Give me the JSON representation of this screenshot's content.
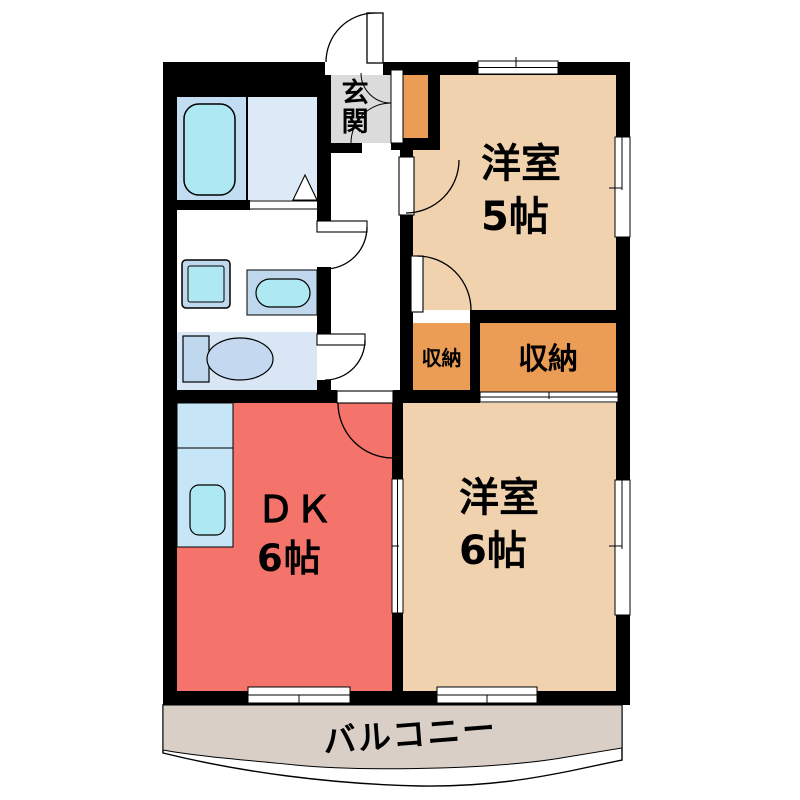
{
  "floorplan": {
    "type": "apartment-floor-plan",
    "entrance": {
      "label": "玄関"
    },
    "rooms": {
      "western5": {
        "name": "洋室",
        "size": "5帖"
      },
      "western6": {
        "name": "洋室",
        "size": "6帖"
      },
      "dk": {
        "name": "ＤＫ",
        "size": "6帖"
      },
      "closet_small": {
        "label": "収納"
      },
      "closet_large": {
        "label": "収納"
      },
      "balcony": {
        "label": "バルコニー"
      }
    },
    "fixtures": [
      "bathtub",
      "bath-door-triangle",
      "washing-machine",
      "wash-basin",
      "toilet",
      "kitchen-counter",
      "kitchen-sink",
      "shoe-cabinet"
    ],
    "colors": {
      "wall": "#000000",
      "room_peach": "#F1D2AF",
      "closet_orange": "#EB9C55",
      "dk_red": "#F4736B",
      "entrance_gray": "#DBDBDB",
      "balcony_tan": "#D9CFC7",
      "bath_blue_dark": "#C2DCF2",
      "bath_blue_light": "#DCEAF8",
      "toilet_room_blue": "#D8E6F5",
      "fixture_cyan": "#AEE8F2",
      "fixture_blue": "#BFD8EE",
      "kitchen_blue": "#C6E6F7",
      "toilet_bowl_blue": "#C4D9EF",
      "white": "#FFFFFF"
    }
  }
}
